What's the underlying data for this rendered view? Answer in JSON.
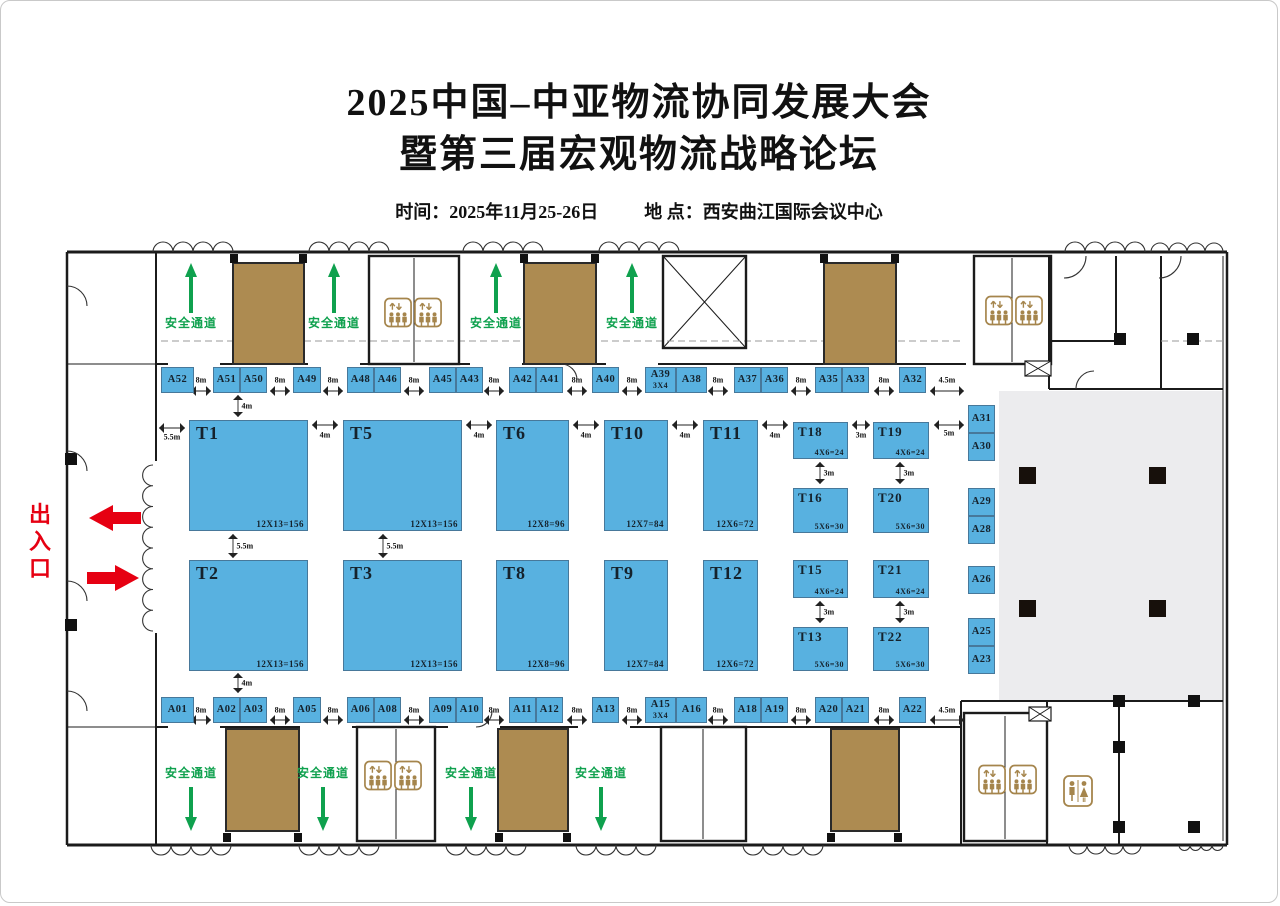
{
  "title": {
    "line1": "2025中国–中亚物流协同发展大会",
    "line2": "暨第三届宏观物流战略论坛"
  },
  "info": {
    "time_label": "时间：",
    "time_value": "2025年11月25-26日",
    "place_label": "地 点：",
    "place_value": "西安曲江国际会议中心"
  },
  "labels": {
    "entrance": "出入口",
    "safety_channel": "安全通道"
  },
  "colors": {
    "booth": "#58b1e0",
    "stairwell": "#ad8b51",
    "green": "#0fa14e",
    "red": "#e60012",
    "gray_area": "#ececee",
    "wall": "#1b1b1b",
    "icon_brown": "#a5854c"
  },
  "booths": {
    "large": [
      {
        "id": "T1",
        "size": "12X13=156",
        "x": 188,
        "y": 419,
        "w": 119,
        "h": 111
      },
      {
        "id": "T5",
        "size": "12X13=156",
        "x": 342,
        "y": 419,
        "w": 119,
        "h": 111
      },
      {
        "id": "T6",
        "size": "12X8=96",
        "x": 495,
        "y": 419,
        "w": 73,
        "h": 111
      },
      {
        "id": "T10",
        "size": "12X7=84",
        "x": 603,
        "y": 419,
        "w": 64,
        "h": 111
      },
      {
        "id": "T11",
        "size": "12X6=72",
        "x": 702,
        "y": 419,
        "w": 55,
        "h": 111
      },
      {
        "id": "T18",
        "size": "4X6=24",
        "x": 792,
        "y": 421,
        "w": 55,
        "h": 37
      },
      {
        "id": "T19",
        "size": "4X6=24",
        "x": 872,
        "y": 421,
        "w": 56,
        "h": 37
      },
      {
        "id": "T16",
        "size": "5X6=30",
        "x": 792,
        "y": 487,
        "w": 55,
        "h": 45
      },
      {
        "id": "T20",
        "size": "5X6=30",
        "x": 872,
        "y": 487,
        "w": 56,
        "h": 45
      },
      {
        "id": "T2",
        "size": "12X13=156",
        "x": 188,
        "y": 559,
        "w": 119,
        "h": 111
      },
      {
        "id": "T3",
        "size": "12X13=156",
        "x": 342,
        "y": 559,
        "w": 119,
        "h": 111
      },
      {
        "id": "T8",
        "size": "12X8=96",
        "x": 495,
        "y": 559,
        "w": 73,
        "h": 111
      },
      {
        "id": "T9",
        "size": "12X7=84",
        "x": 603,
        "y": 559,
        "w": 64,
        "h": 111
      },
      {
        "id": "T12",
        "size": "12X6=72",
        "x": 702,
        "y": 559,
        "w": 55,
        "h": 111
      },
      {
        "id": "T15",
        "size": "4X6=24",
        "x": 792,
        "y": 559,
        "w": 55,
        "h": 38
      },
      {
        "id": "T21",
        "size": "4X6=24",
        "x": 872,
        "y": 559,
        "w": 56,
        "h": 38
      },
      {
        "id": "T13",
        "size": "5X6=30",
        "x": 792,
        "y": 626,
        "w": 55,
        "h": 44
      },
      {
        "id": "T22",
        "size": "5X6=30",
        "x": 872,
        "y": 626,
        "w": 56,
        "h": 44
      }
    ],
    "top_row": [
      {
        "id": "A52",
        "x": 160,
        "w": 33
      },
      {
        "id": "A51",
        "x": 212,
        "w": 27
      },
      {
        "id": "A50",
        "x": 239,
        "w": 27
      },
      {
        "id": "A49",
        "x": 292,
        "w": 28
      },
      {
        "id": "A48",
        "x": 346,
        "w": 27
      },
      {
        "id": "A46",
        "x": 373,
        "w": 27
      },
      {
        "id": "A45",
        "x": 428,
        "w": 27
      },
      {
        "id": "A43",
        "x": 455,
        "w": 27
      },
      {
        "id": "A42",
        "x": 508,
        "w": 27
      },
      {
        "id": "A41",
        "x": 535,
        "w": 27
      },
      {
        "id": "A40",
        "x": 591,
        "w": 27
      },
      {
        "id": "A39",
        "sub": "3X4",
        "x": 644,
        "w": 31
      },
      {
        "id": "A38",
        "x": 675,
        "w": 31
      },
      {
        "id": "A37",
        "x": 733,
        "w": 27
      },
      {
        "id": "A36",
        "x": 760,
        "w": 27
      },
      {
        "id": "A35",
        "x": 814,
        "w": 27
      },
      {
        "id": "A33",
        "x": 841,
        "w": 27
      },
      {
        "id": "A32",
        "x": 898,
        "w": 27
      }
    ],
    "bottom_row": [
      {
        "id": "A01",
        "x": 160,
        "w": 33
      },
      {
        "id": "A02",
        "x": 212,
        "w": 27
      },
      {
        "id": "A03",
        "x": 239,
        "w": 27
      },
      {
        "id": "A05",
        "x": 292,
        "w": 28
      },
      {
        "id": "A06",
        "x": 346,
        "w": 27
      },
      {
        "id": "A08",
        "x": 373,
        "w": 27
      },
      {
        "id": "A09",
        "x": 428,
        "w": 27
      },
      {
        "id": "A10",
        "x": 455,
        "w": 27
      },
      {
        "id": "A11",
        "x": 508,
        "w": 27
      },
      {
        "id": "A12",
        "x": 535,
        "w": 27
      },
      {
        "id": "A13",
        "x": 591,
        "w": 27
      },
      {
        "id": "A15",
        "sub": "3X4",
        "x": 644,
        "w": 31
      },
      {
        "id": "A16",
        "x": 675,
        "w": 31
      },
      {
        "id": "A18",
        "x": 733,
        "w": 27
      },
      {
        "id": "A19",
        "x": 760,
        "w": 27
      },
      {
        "id": "A20",
        "x": 814,
        "w": 27
      },
      {
        "id": "A21",
        "x": 841,
        "w": 27
      },
      {
        "id": "A22",
        "x": 898,
        "w": 27
      }
    ],
    "right_col": [
      {
        "id": "A31",
        "y": 404
      },
      {
        "id": "A30",
        "y": 432
      },
      {
        "id": "A29",
        "y": 487
      },
      {
        "id": "A28",
        "y": 515
      },
      {
        "id": "A26",
        "y": 565
      },
      {
        "id": "A25",
        "y": 617
      },
      {
        "id": "A23",
        "y": 645
      }
    ]
  },
  "dimensions": [
    {
      "t": "8m",
      "x": 200,
      "y": 379,
      "o": "h",
      "len": 20,
      "off": 11
    },
    {
      "t": "8m",
      "x": 279,
      "y": 379,
      "o": "h",
      "len": 20,
      "off": 11
    },
    {
      "t": "8m",
      "x": 332,
      "y": 379,
      "o": "h",
      "len": 20,
      "off": 11
    },
    {
      "t": "8m",
      "x": 413,
      "y": 379,
      "o": "h",
      "len": 20,
      "off": 11
    },
    {
      "t": "8m",
      "x": 493,
      "y": 379,
      "o": "h",
      "len": 20,
      "off": 11
    },
    {
      "t": "8m",
      "x": 576,
      "y": 379,
      "o": "h",
      "len": 20,
      "off": 11
    },
    {
      "t": "8m",
      "x": 631,
      "y": 379,
      "o": "h",
      "len": 20,
      "off": 11
    },
    {
      "t": "8m",
      "x": 717,
      "y": 379,
      "o": "h",
      "len": 20,
      "off": 11
    },
    {
      "t": "8m",
      "x": 800,
      "y": 379,
      "o": "h",
      "len": 20,
      "off": 11
    },
    {
      "t": "8m",
      "x": 883,
      "y": 379,
      "o": "h",
      "len": 20,
      "off": 11
    },
    {
      "t": "4.5m",
      "x": 946,
      "y": 379,
      "o": "h",
      "len": 34,
      "off": 11
    },
    {
      "t": "8m",
      "x": 200,
      "y": 709,
      "o": "h",
      "len": 20,
      "off": 10
    },
    {
      "t": "8m",
      "x": 279,
      "y": 709,
      "o": "h",
      "len": 20,
      "off": 10
    },
    {
      "t": "8m",
      "x": 332,
      "y": 709,
      "o": "h",
      "len": 20,
      "off": 10
    },
    {
      "t": "8m",
      "x": 413,
      "y": 709,
      "o": "h",
      "len": 20,
      "off": 10
    },
    {
      "t": "8m",
      "x": 493,
      "y": 709,
      "o": "h",
      "len": 20,
      "off": 10
    },
    {
      "t": "8m",
      "x": 576,
      "y": 709,
      "o": "h",
      "len": 20,
      "off": 10
    },
    {
      "t": "8m",
      "x": 631,
      "y": 709,
      "o": "h",
      "len": 20,
      "off": 10
    },
    {
      "t": "8m",
      "x": 717,
      "y": 709,
      "o": "h",
      "len": 20,
      "off": 10
    },
    {
      "t": "8m",
      "x": 800,
      "y": 709,
      "o": "h",
      "len": 20,
      "off": 10
    },
    {
      "t": "8m",
      "x": 883,
      "y": 709,
      "o": "h",
      "len": 20,
      "off": 10
    },
    {
      "t": "4.5m",
      "x": 946,
      "y": 709,
      "o": "h",
      "len": 34,
      "off": 10
    },
    {
      "t": "5.5m",
      "x": 171,
      "y": 436,
      "o": "h",
      "len": 26,
      "off": -9
    },
    {
      "t": "4m",
      "x": 324,
      "y": 434,
      "o": "h",
      "len": 26,
      "off": -10
    },
    {
      "t": "4m",
      "x": 478,
      "y": 434,
      "o": "h",
      "len": 26,
      "off": -10
    },
    {
      "t": "4m",
      "x": 585,
      "y": 434,
      "o": "h",
      "len": 26,
      "off": -10
    },
    {
      "t": "4m",
      "x": 684,
      "y": 434,
      "o": "h",
      "len": 26,
      "off": -10
    },
    {
      "t": "4m",
      "x": 774,
      "y": 434,
      "o": "h",
      "len": 26,
      "off": -10
    },
    {
      "t": "3m",
      "x": 860,
      "y": 434,
      "o": "h",
      "len": 18,
      "off": -10
    },
    {
      "t": "5m",
      "x": 948,
      "y": 432,
      "o": "h",
      "len": 30,
      "off": -8
    },
    {
      "t": "4m",
      "x": 237,
      "y": 405,
      "o": "v",
      "len": 22
    },
    {
      "t": "5.5m",
      "x": 232,
      "y": 545,
      "o": "v",
      "len": 24
    },
    {
      "t": "5.5m",
      "x": 382,
      "y": 545,
      "o": "v",
      "len": 24
    },
    {
      "t": "4m",
      "x": 237,
      "y": 682,
      "o": "v",
      "len": 20
    },
    {
      "t": "3m",
      "x": 819,
      "y": 472,
      "o": "v",
      "len": 22
    },
    {
      "t": "3m",
      "x": 899,
      "y": 472,
      "o": "v",
      "len": 22
    },
    {
      "t": "3m",
      "x": 819,
      "y": 611,
      "o": "v",
      "len": 22
    },
    {
      "t": "3m",
      "x": 899,
      "y": 611,
      "o": "v",
      "len": 22
    }
  ],
  "safety_channels": {
    "top_x": [
      190,
      333,
      495,
      631
    ],
    "bottom_x": [
      190,
      322,
      470,
      600
    ]
  }
}
